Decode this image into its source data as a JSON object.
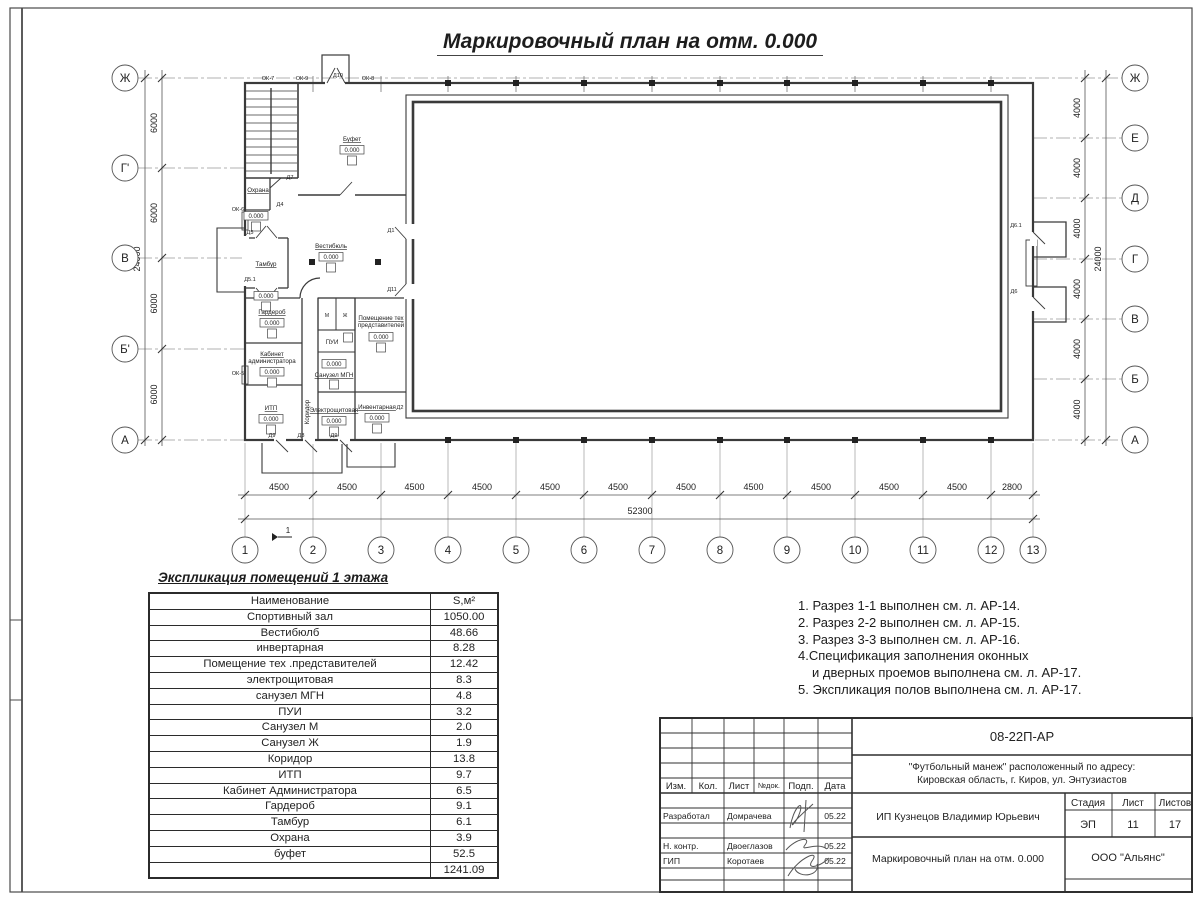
{
  "sheet": {
    "title": "Маркировочный план на отм. 0.000"
  },
  "plan": {
    "axes_left": [
      "Ж",
      "Г'",
      "В",
      "Б'",
      "А"
    ],
    "axes_right": [
      "Ж",
      "Е",
      "Д",
      "Г",
      "В",
      "Б",
      "А"
    ],
    "axes_bottom": [
      "1",
      "2",
      "3",
      "4",
      "5",
      "6",
      "7",
      "8",
      "9",
      "10",
      "11",
      "12",
      "13"
    ],
    "dims_left": [
      "6000",
      "6000",
      "6000",
      "6000"
    ],
    "dims_left_total": "24000",
    "dims_right": [
      "4000",
      "4000",
      "4000",
      "4000",
      "4000",
      "4000"
    ],
    "dims_right_total": "24000",
    "dims_bottom": [
      "4500",
      "4500",
      "4500",
      "4500",
      "4500",
      "4500",
      "4500",
      "4500",
      "4500",
      "4500",
      "4500",
      "2800"
    ],
    "dims_bottom_total": "52300",
    "section_mark": "1",
    "level_mark": "0.000",
    "rooms": [
      {
        "label": "Буфет",
        "level": "0.000"
      },
      {
        "label": "Вестибюль",
        "level": "0.000"
      },
      {
        "label": "Охрана",
        "level": "0.000"
      },
      {
        "label": "Тамбур",
        "level": "0.000"
      },
      {
        "label": "Гардероб",
        "level": "0.000"
      },
      {
        "label": "Кабинет",
        "label2": "администратора",
        "level": "0.000"
      },
      {
        "label": "ИТП",
        "level": "0.000"
      },
      {
        "label": "Коридор"
      },
      {
        "label": "ПУИ"
      },
      {
        "label": "Санузел МГН",
        "level": "0.000"
      },
      {
        "label": "Помещение тех",
        "label2": "представителей",
        "level": "0.000"
      },
      {
        "label": "Электрощитовая",
        "level": "0.000"
      },
      {
        "label": "Инвентарная",
        "level": "0.000"
      },
      {
        "label": "М"
      },
      {
        "label": "Ж"
      }
    ],
    "openings": [
      "ОК-7",
      "ОК-9",
      "Д10",
      "ОК-8",
      "ОК-6",
      "ОК-5",
      "Д7",
      "Д4",
      "Д5",
      "Д5.1",
      "Д1",
      "Д11",
      "Д2",
      "Д6.1",
      "Д6",
      "Д9",
      "Д8",
      "Д9"
    ]
  },
  "legend": {
    "heading": "Экспликация помещений 1 этажа",
    "col_name": "Наименование",
    "col_area": "S,м²",
    "rows": [
      {
        "name": "Спортивный зал",
        "area": "1050.00"
      },
      {
        "name": "Вестибюлб",
        "area": "48.66"
      },
      {
        "name": "инвертарная",
        "area": "8.28"
      },
      {
        "name": "Помещение тех .представителей",
        "area": "12.42"
      },
      {
        "name": "электрощитовая",
        "area": "8.3"
      },
      {
        "name": "санузел МГН",
        "area": "4.8"
      },
      {
        "name": "ПУИ",
        "area": "3.2"
      },
      {
        "name": "Санузел М",
        "area": "2.0"
      },
      {
        "name": "Санузел Ж",
        "area": "1.9"
      },
      {
        "name": "Коридор",
        "area": "13.8"
      },
      {
        "name": "ИТП",
        "area": "9.7"
      },
      {
        "name": "Кабинет Администратора",
        "area": "6.5"
      },
      {
        "name": "Гардероб",
        "area": "9.1"
      },
      {
        "name": "Тамбур",
        "area": "6.1"
      },
      {
        "name": "Охрана",
        "area": "3.9"
      },
      {
        "name": "буфет",
        "area": "52.5"
      }
    ],
    "total": "1241.09"
  },
  "notes": [
    {
      "text": "1. Разрез 1-1 выполнен см. л. АР-14.",
      "indent": false
    },
    {
      "text": "2. Разрез 2-2 выполнен см. л. АР-15.",
      "indent": false
    },
    {
      "text": "3. Разрез 3-3 выполнен см. л. АР-16.",
      "indent": false
    },
    {
      "text": "4.Спецификация заполнения оконных",
      "indent": false
    },
    {
      "text": "и дверных проемов выполнена см. л. АР-17.",
      "indent": true
    },
    {
      "text": "5. Экспликация полов выполнена см. л. АР-17.",
      "indent": false
    }
  ],
  "stamp": {
    "doc_code": "08-22П-АР",
    "project_line1": "\"Футбольный манеж\" расположенный по адресу:",
    "project_line2": "Кировская область, г. Киров, ул. Энтузиастов",
    "client": "ИП Кузнецов Владимир Юрьевич",
    "sheet_title": "Маркировочный план на отм. 0.000",
    "org": "ООО \"Альянс\"",
    "cols": [
      "Изм.",
      "Кол.",
      "Лист",
      "№док.",
      "Подп.",
      "Дата"
    ],
    "stage_header": [
      "Стадия",
      "Лист",
      "Листов"
    ],
    "stage_values": [
      "ЭП",
      "11",
      "17"
    ],
    "roles": [
      {
        "role": "Разработал",
        "name": "Домрачева",
        "date": "05.22"
      },
      {
        "role": "Н. контр.",
        "name": "Двоеглазов",
        "date": "05.22"
      },
      {
        "role": "ГИП",
        "name": "Коротаев",
        "date": "05.22"
      }
    ]
  }
}
